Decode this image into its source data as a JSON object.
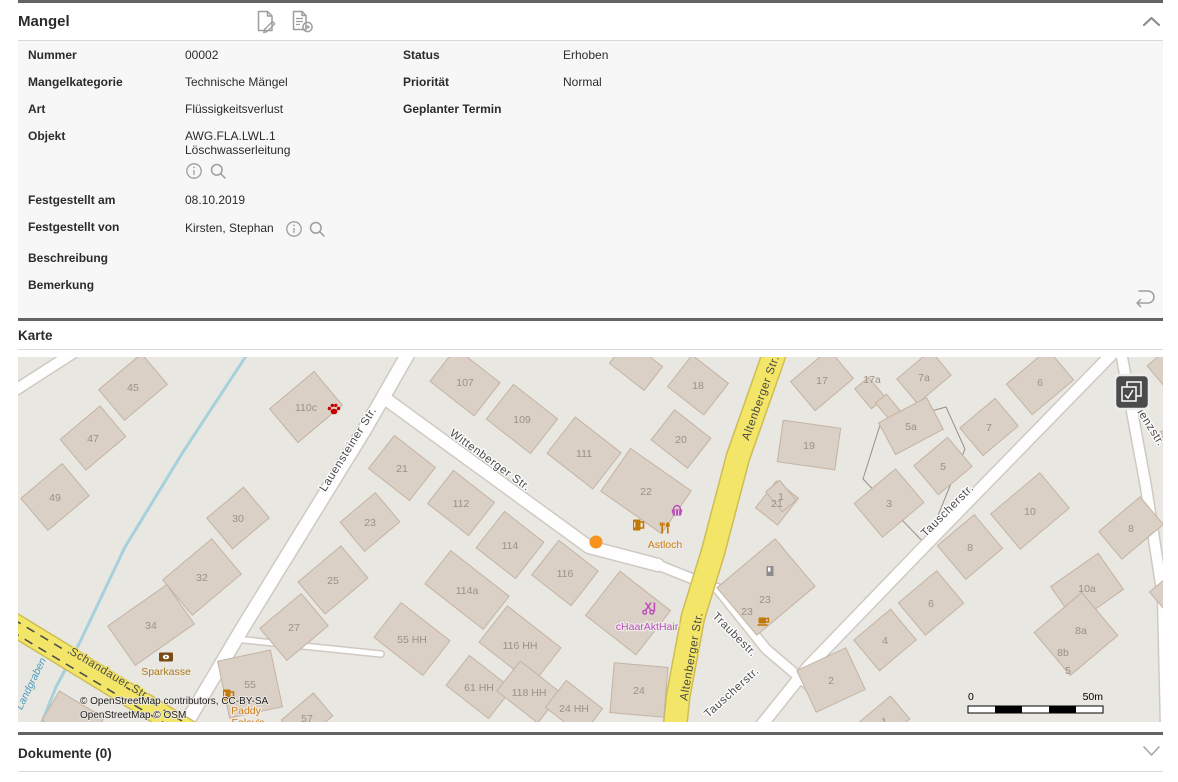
{
  "mangel": {
    "title": "Mangel",
    "left": [
      {
        "label": "Nummer",
        "value": "00002"
      },
      {
        "label": "Mangelkategorie",
        "value": "Technische Mängel"
      },
      {
        "label": "Art",
        "value": "Flüssigkeitsverlust"
      },
      {
        "label": "Objekt",
        "value": "AWG.FLA.LWL.1 Löschwasserleitung",
        "value_line1": "AWG.FLA.LWL.1",
        "value_line2": "Löschwasserleitung"
      },
      {
        "label": "Festgestellt am",
        "value": "08.10.2019"
      },
      {
        "label": "Festgestellt von",
        "value": "Kirsten, Stephan"
      },
      {
        "label": "Beschreibung",
        "value": ""
      },
      {
        "label": "Bemerkung",
        "value": ""
      }
    ],
    "right": [
      {
        "label": "Status",
        "value": "Erhoben"
      },
      {
        "label": "Priorität",
        "value": "Normal"
      },
      {
        "label": "Geplanter Termin",
        "value": ""
      }
    ]
  },
  "karte": {
    "title": "Karte"
  },
  "dokumente": {
    "title": "Dokumente (0)"
  },
  "map": {
    "colors": {
      "land": "#e9e7e2",
      "water": "#a7d0dd",
      "road": "#fefefe",
      "road_casing": "#cfc9c1",
      "road_yellow": "#f3e567",
      "road_yellow_casing": "#cdbd54",
      "building": "#dbd0c5",
      "building_stroke": "#c3b3a2",
      "marker": "#f7941e"
    },
    "boundaries": [
      [
        [
          862,
          68
        ],
        [
          928,
          50
        ],
        [
          947,
          92
        ],
        [
          908,
          188
        ],
        [
          845,
          122
        ]
      ]
    ],
    "stream": {
      "points": [
        [
          230,
          -4
        ],
        [
          165,
          95
        ],
        [
          107,
          190
        ],
        [
          62,
          285
        ],
        [
          38,
          330
        ],
        [
          22,
          370
        ]
      ]
    },
    "roads": [
      {
        "points": [
          [
            -4,
            34
          ],
          [
            58,
            -6
          ]
        ],
        "width": 10,
        "layer": 0
      },
      {
        "points": [
          [
            217,
            282
          ],
          [
            363,
            297
          ]
        ],
        "width": 5,
        "layer": 0
      },
      {
        "points": [
          [
            391,
            -5
          ],
          [
            347,
            72
          ],
          [
            224,
            272
          ],
          [
            166,
            370
          ]
        ],
        "width": 13,
        "layer": 0
      },
      {
        "points": [
          [
            365,
            40
          ],
          [
            571,
            190
          ],
          [
            640,
            208
          ]
        ],
        "width": 12,
        "layer": 0
      },
      {
        "points": [
          [
            640,
            208
          ],
          [
            700,
            232
          ],
          [
            748,
            292
          ],
          [
            795,
            332
          ]
        ],
        "width": 9,
        "layer": 0
      },
      {
        "points": [
          [
            1096,
            -5
          ],
          [
            900,
            196
          ],
          [
            790,
            310
          ],
          [
            742,
            370
          ]
        ],
        "width": 11,
        "layer": 0
      },
      {
        "points": [
          [
            1103,
            -5
          ],
          [
            1128,
            130
          ],
          [
            1145,
            240
          ],
          [
            1148,
            370
          ]
        ],
        "width": 10,
        "layer": 0
      },
      {
        "points": [
          [
            -5,
            267
          ],
          [
            160,
            368
          ],
          [
            200,
            392
          ]
        ],
        "width": 21,
        "layer": 1
      },
      {
        "points": [
          [
            757,
            -5
          ],
          [
            720,
            100
          ],
          [
            695,
            195
          ],
          [
            675,
            260
          ],
          [
            660,
            340
          ],
          [
            657,
            370
          ]
        ],
        "width": 22,
        "layer": 1
      }
    ],
    "tram": [
      [
        [
          -5,
          262
        ],
        [
          164,
          364
        ]
      ],
      [
        [
          -7,
          274
        ],
        [
          156,
          372
        ]
      ]
    ],
    "buildings": [
      [
        115,
        30,
        56,
        40,
        -40,
        "45"
      ],
      [
        75,
        81,
        52,
        40,
        -40,
        "47"
      ],
      [
        37,
        140,
        54,
        42,
        -40,
        "49"
      ],
      [
        220,
        161,
        48,
        40,
        -40,
        "30"
      ],
      [
        184,
        220,
        64,
        46,
        -40,
        "32"
      ],
      [
        133,
        268,
        72,
        48,
        -35,
        "34"
      ],
      [
        288,
        50,
        58,
        44,
        -40,
        "110c"
      ],
      [
        352,
        165,
        46,
        38,
        -40,
        "23"
      ],
      [
        315,
        223,
        56,
        42,
        -40,
        "25"
      ],
      [
        276,
        270,
        54,
        42,
        -40,
        "27"
      ],
      [
        232,
        327,
        54,
        58,
        -12,
        "55"
      ],
      [
        289,
        361,
        42,
        30,
        -40,
        "57"
      ],
      [
        55,
        362,
        52,
        34,
        31,
        ""
      ],
      [
        384,
        111,
        52,
        42,
        38,
        "21"
      ],
      [
        443,
        146,
        52,
        42,
        38,
        "112"
      ],
      [
        492,
        188,
        50,
        46,
        38,
        "114"
      ],
      [
        449,
        233,
        74,
        42,
        38,
        "114a"
      ],
      [
        447,
        25,
        56,
        42,
        38,
        "107"
      ],
      [
        504,
        62,
        56,
        44,
        38,
        "109"
      ],
      [
        566,
        96,
        58,
        46,
        38,
        "111"
      ],
      [
        618,
        8,
        44,
        30,
        38,
        ""
      ],
      [
        680,
        28,
        46,
        40,
        38,
        "18"
      ],
      [
        663,
        82,
        46,
        38,
        38,
        "20"
      ],
      [
        628,
        134,
        74,
        52,
        35,
        "22"
      ],
      [
        759,
        146,
        28,
        34,
        38,
        "21"
      ],
      [
        547,
        216,
        50,
        44,
        38,
        "116"
      ],
      [
        610,
        256,
        64,
        56,
        38,
        ""
      ],
      [
        394,
        282,
        62,
        44,
        38,
        "55 HH"
      ],
      [
        502,
        288,
        68,
        46,
        38,
        "116 HH"
      ],
      [
        461,
        330,
        54,
        38,
        38,
        "61 HH"
      ],
      [
        511,
        335,
        52,
        38,
        38,
        "118 HH"
      ],
      [
        556,
        351,
        46,
        34,
        38,
        "24 HH"
      ],
      [
        621,
        333,
        54,
        50,
        5,
        "24"
      ],
      [
        748,
        230,
        76,
        62,
        -40,
        ""
      ],
      [
        804,
        23,
        50,
        38,
        -40,
        "17"
      ],
      [
        852,
        36,
        18,
        26,
        -40,
        ""
      ],
      [
        870,
        50,
        14,
        22,
        -40,
        ""
      ],
      [
        906,
        20,
        44,
        32,
        -40,
        "7a"
      ],
      [
        1022,
        25,
        54,
        40,
        -40,
        "6"
      ],
      [
        893,
        69,
        54,
        36,
        -28,
        "5a"
      ],
      [
        791,
        88,
        58,
        42,
        8,
        "19"
      ],
      [
        971,
        70,
        46,
        36,
        -40,
        "7"
      ],
      [
        925,
        109,
        44,
        38,
        -40,
        "5"
      ],
      [
        871,
        146,
        54,
        44,
        -40,
        "3"
      ],
      [
        1012,
        154,
        64,
        46,
        -40,
        "10"
      ],
      [
        1113,
        171,
        54,
        36,
        -40,
        "8"
      ],
      [
        1152,
        8,
        36,
        28,
        -40,
        ""
      ],
      [
        763,
        139,
        18,
        26,
        -40,
        "1"
      ],
      [
        952,
        190,
        48,
        44,
        -40,
        "8"
      ],
      [
        913,
        246,
        50,
        42,
        -40,
        "6"
      ],
      [
        867,
        283,
        48,
        40,
        -40,
        "4"
      ],
      [
        813,
        323,
        54,
        46,
        -25,
        "2"
      ],
      [
        866,
        364,
        42,
        30,
        -40,
        "1"
      ],
      [
        1069,
        231,
        58,
        44,
        -35,
        "10a"
      ],
      [
        1058,
        277,
        62,
        56,
        -40,
        ""
      ],
      [
        1152,
        236,
        30,
        28,
        -40,
        ""
      ],
      [
        1163,
        100,
        26,
        60,
        -15,
        ""
      ]
    ],
    "house_labels": [
      [
        747,
        246,
        "23"
      ],
      [
        729,
        258,
        "23"
      ],
      [
        1063,
        277,
        "8a"
      ],
      [
        1045,
        299,
        "8b"
      ],
      [
        1050,
        317,
        "5"
      ],
      [
        854,
        26,
        "17a"
      ]
    ],
    "street_labels": [
      {
        "t": "Lauensteiner Str.",
        "x": 333,
        "y": 94,
        "r": -58,
        "halo": "#fefefe"
      },
      {
        "t": "Wittenberger Str.",
        "x": 470,
        "y": 106,
        "r": 36,
        "halo": "#fefefe"
      },
      {
        "t": "Altenberger Str.",
        "x": 746,
        "y": 42,
        "r": -70,
        "halo": "#f3e567"
      },
      {
        "t": "Altenberger Str.",
        "x": 677,
        "y": 300,
        "r": -80,
        "halo": "#f3e567"
      },
      {
        "t": "Tauscherstr.",
        "x": 932,
        "y": 156,
        "r": -45,
        "halo": "#fefefe"
      },
      {
        "t": "Tauscherstr.",
        "x": 716,
        "y": 338,
        "r": -42,
        "halo": "#fefefe"
      },
      {
        "t": "Traubestr.",
        "x": 714,
        "y": 280,
        "r": 45,
        "halo": "#fefefe"
      },
      {
        "t": "Schandauer Str.",
        "x": 90,
        "y": 320,
        "r": 31,
        "halo": "#f3e567"
      },
      {
        "t": "Polenzstr.",
        "x": 1126,
        "y": 66,
        "r": 58,
        "halo": "#fefefe"
      },
      {
        "t": "Landgraben",
        "x": 16,
        "y": 328,
        "r": -64,
        "halo": "#e9e7e3",
        "water": true
      }
    ],
    "pois": [
      {
        "k": "paw",
        "x": 316,
        "y": 52,
        "c": "#c40000"
      },
      {
        "k": "basket",
        "x": 659,
        "y": 154,
        "c": "#ba4cba"
      },
      {
        "k": "beer",
        "x": 620,
        "y": 168,
        "c": "#c17807"
      },
      {
        "k": "restaurant",
        "x": 647,
        "y": 171,
        "c": "#c17807"
      },
      {
        "k": "hairdresser",
        "x": 631,
        "y": 251,
        "c": "#ba4cba"
      },
      {
        "k": "bank",
        "x": 148,
        "y": 300,
        "c": "#7a4b12"
      },
      {
        "k": "cafe",
        "x": 745,
        "y": 264,
        "c": "#c17807"
      },
      {
        "k": "pub",
        "x": 210,
        "y": 338,
        "c": "#c17807"
      },
      {
        "k": "vending",
        "x": 752,
        "y": 214,
        "c": "#8d8d8d"
      }
    ],
    "poi_labels": [
      {
        "t": "Astloch",
        "x": 647,
        "y": 191,
        "c": "#cf7d15"
      },
      {
        "t": "cHaarAktHair",
        "x": 629,
        "y": 273,
        "c": "#bb4fbb"
      },
      {
        "t": "Sparkasse",
        "x": 148,
        "y": 318,
        "c": "#aa7a1c"
      },
      {
        "t": "Paddy",
        "x": 228,
        "y": 357,
        "c": "#cf7d15"
      },
      {
        "t": "Foley's",
        "x": 230,
        "y": 369,
        "c": "#cf7d15"
      }
    ],
    "marker": {
      "x": 578,
      "y": 185,
      "r": 6.5
    },
    "attribution": [
      "© OpenStreetMap contributors, CC-BY-SA",
      "OpenStreetMap © OSM"
    ],
    "scale": {
      "x": 950,
      "y": 349,
      "w": 135,
      "label_left": "0",
      "label_right": "50m"
    }
  }
}
